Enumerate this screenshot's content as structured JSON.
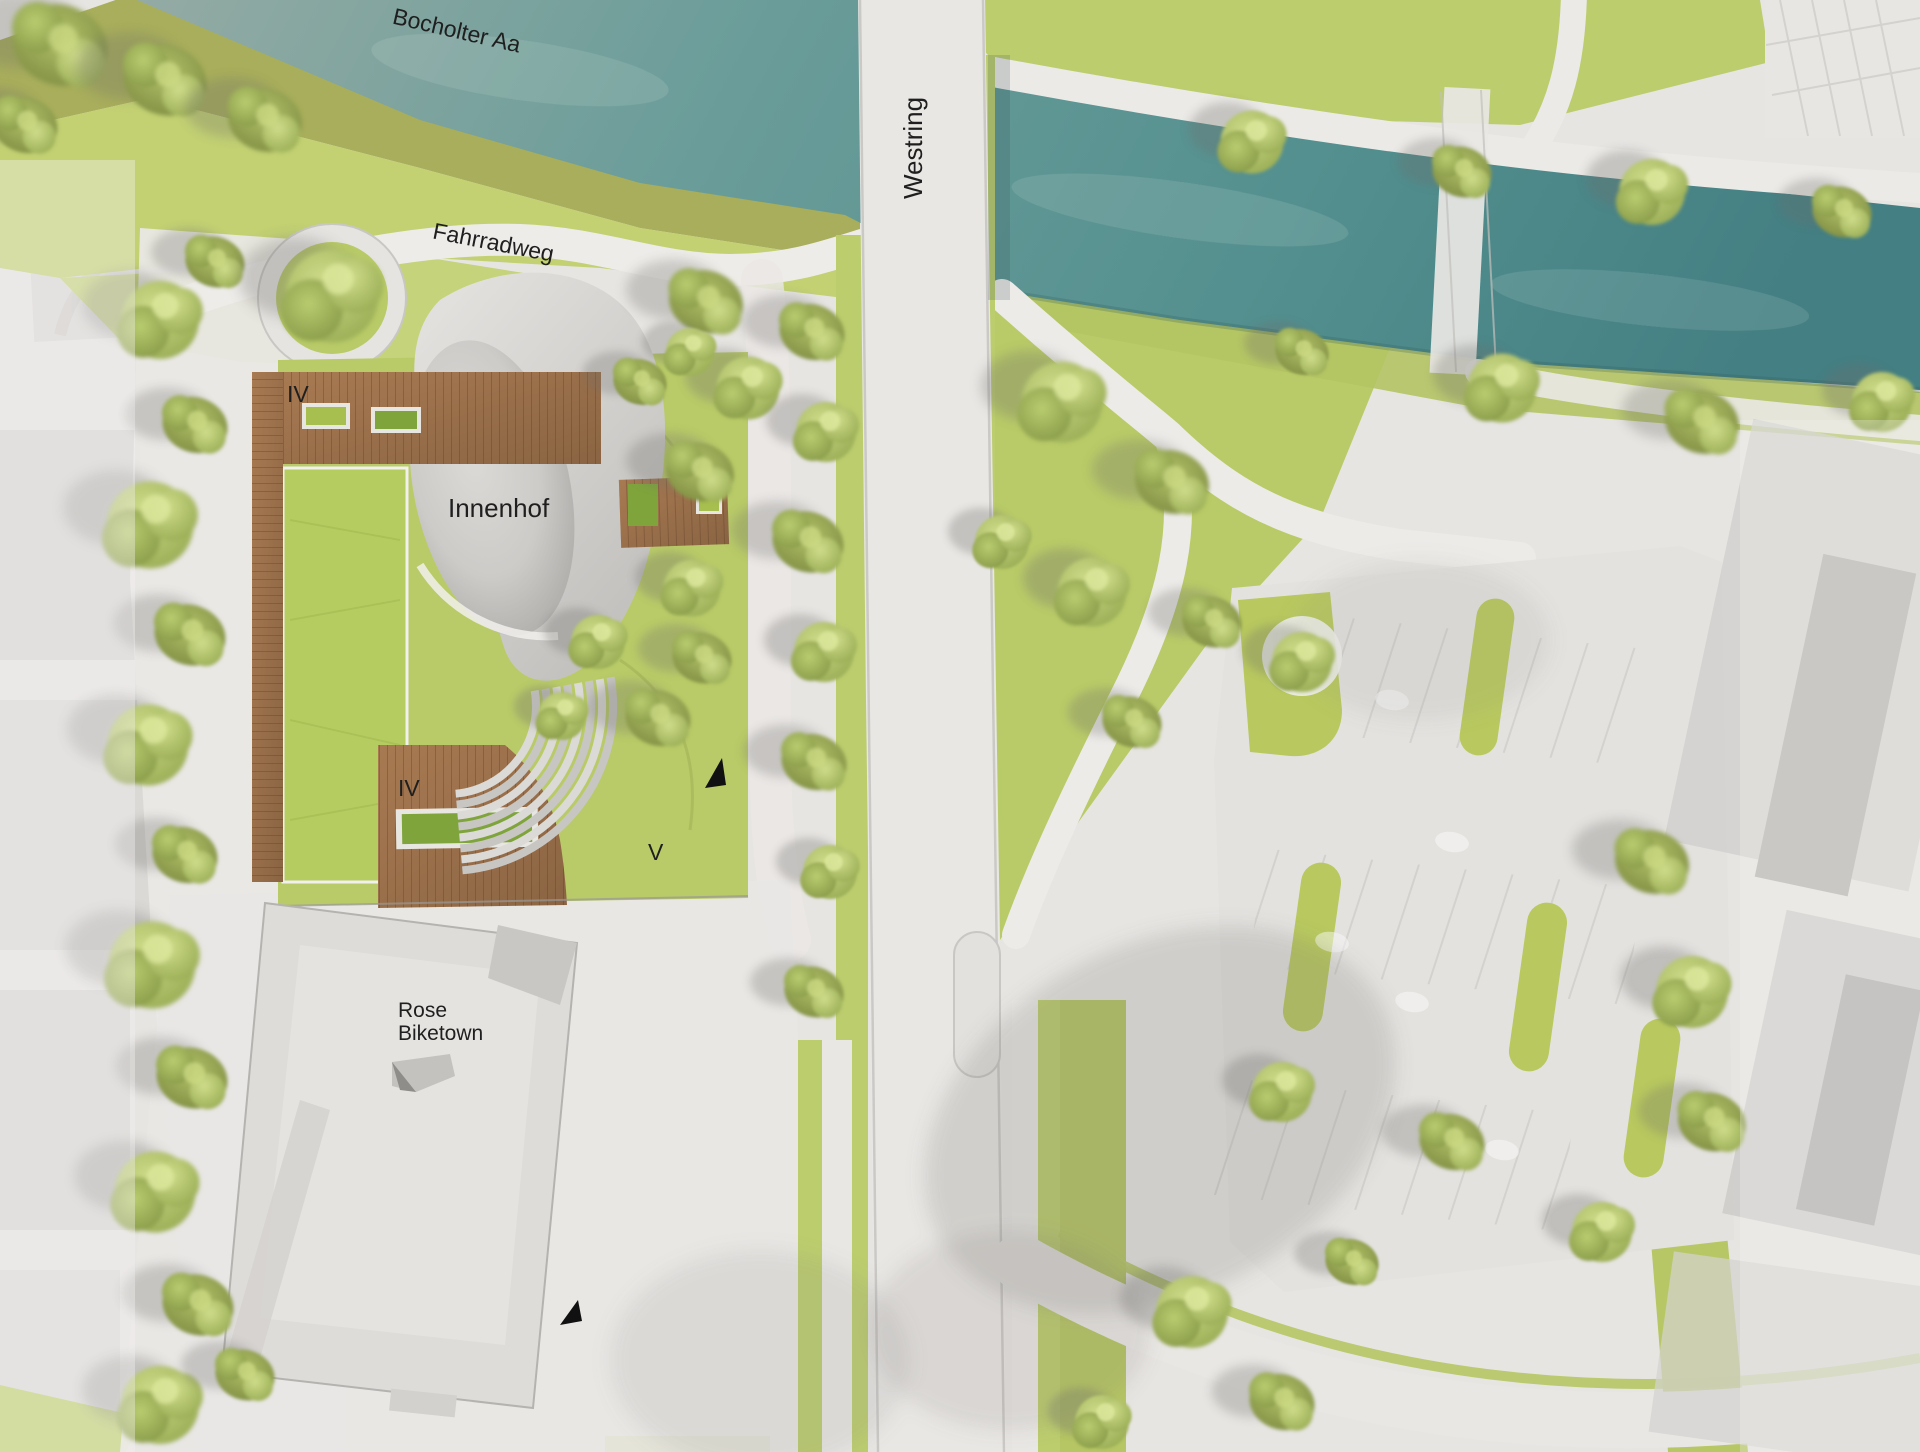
{
  "plan": {
    "labels": {
      "river": "Bocholter Aa",
      "street_vertical": "Westring",
      "bike_path": "Fahrradweg",
      "courtyard": "Innenhof",
      "floors_roof_deck": "IV",
      "floors_lower_deck": "IV",
      "floors_v_wing": "V",
      "building_line1": "Rose",
      "building_line2": "Biketown"
    },
    "icons": {
      "entrance_marker": "black-triangle-arrow"
    },
    "colors": {
      "ground": "#e7e5e2",
      "river_left": "#95aba4",
      "river_mid": "#5f9997",
      "river_right": "#447f83",
      "grass": "#c3d173",
      "grass_olive": "#a8ae5b",
      "park": "#b9cb68",
      "green_roof": "#b5cd60",
      "wood": "#9e744e",
      "path": "#edebe8",
      "courtyard_light": "#d8d6d3",
      "courtyard_dark": "#a6a4a1",
      "building_light": "#dedcd9",
      "ghost_gray": "#cfcecc",
      "tree_light": "#cfdd8a",
      "tree_dark": "#75843c",
      "label_ink": "#1f1f1f",
      "marker_ink": "#111111"
    }
  }
}
